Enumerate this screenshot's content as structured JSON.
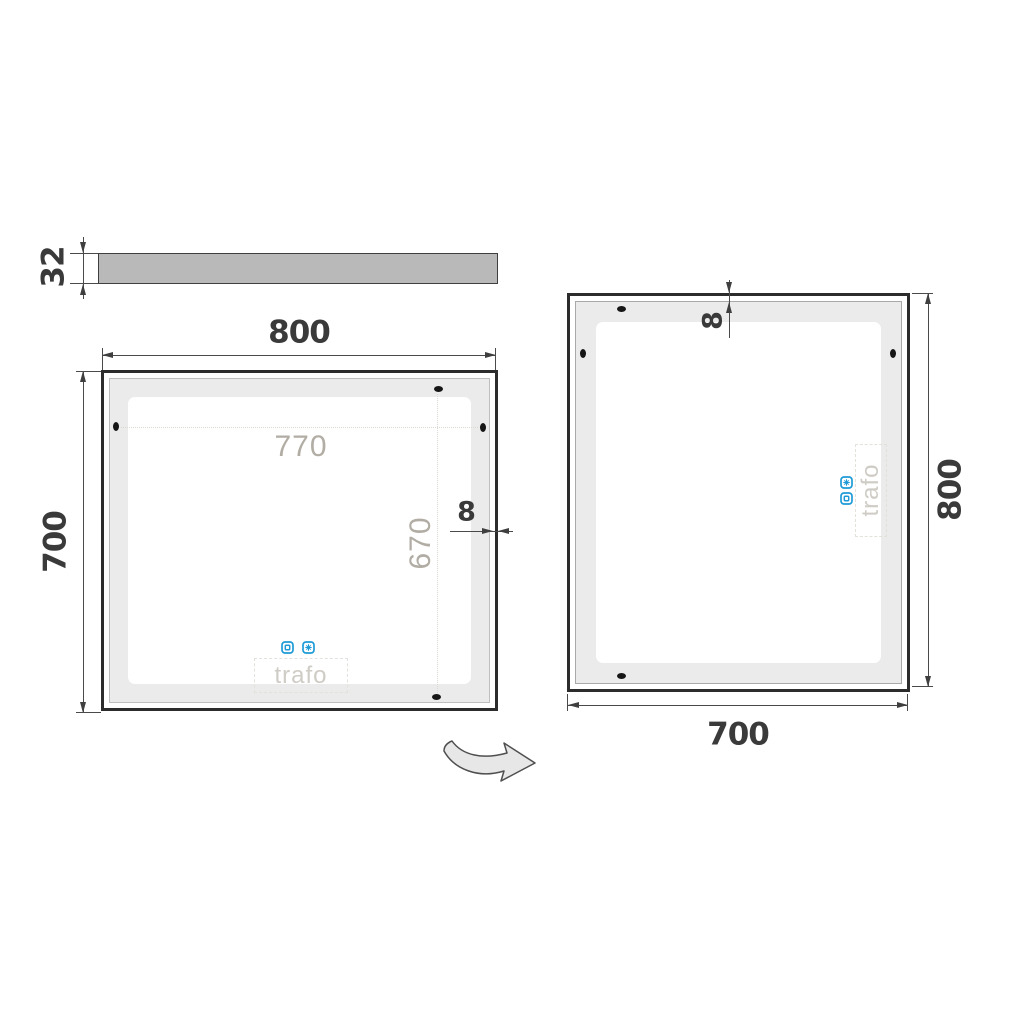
{
  "drawing": {
    "side_view": {
      "thickness": "32"
    },
    "front_view": {
      "width": "800",
      "height": "700",
      "led_width": "770",
      "led_height": "670",
      "edge_gap": "8",
      "trafo": "trafo"
    },
    "rotated_view": {
      "width": "700",
      "height": "800",
      "edge_gap": "8",
      "trafo": "trafo"
    },
    "icons": {
      "touch": "touch-sensor-icon",
      "defog": "defog-icon"
    },
    "colors": {
      "accent_blue": "#1e9bd7",
      "frame": "#2c2c2c",
      "led_band": "#ebebeb",
      "side_bar_fill": "#b9b9b9",
      "dim_text": "#3a3a3a",
      "ghost_text": "#b2ada4",
      "trafo_text": "#cfccc5"
    }
  }
}
